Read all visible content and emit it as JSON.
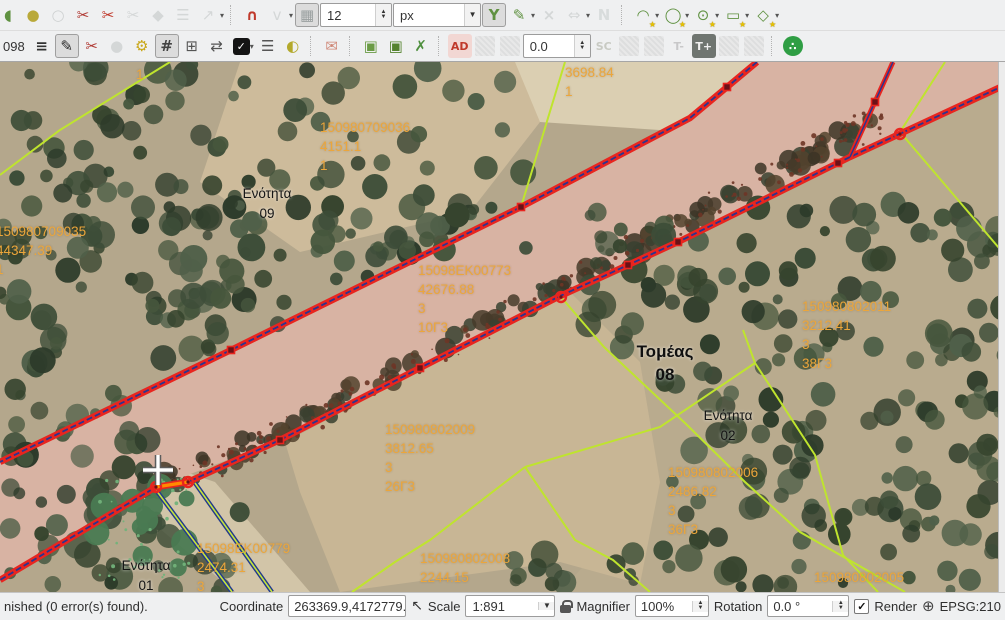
{
  "toolbar_row1": {
    "items": [
      {
        "type": "btn",
        "name": "offset-point-tool-icon",
        "glyph": "◖",
        "color": "#5f9140",
        "clip": true
      },
      {
        "type": "btn",
        "name": "move-feature-icon",
        "glyph": "●",
        "color": "#b9a93a"
      },
      {
        "type": "btn",
        "name": "simplify-feature-icon",
        "glyph": "○",
        "color": "#9aa0a0",
        "disabled": true
      },
      {
        "type": "btn",
        "name": "node-scissors-icon",
        "glyph": "✂",
        "color": "#b03a34"
      },
      {
        "type": "btn",
        "name": "split-features-icon",
        "glyph": "✂",
        "color": "#c0392b"
      },
      {
        "type": "btn",
        "name": "split-parts-icon",
        "glyph": "✂",
        "color": "#a9afaf",
        "disabled": true
      },
      {
        "type": "btn",
        "name": "merge-features-icon",
        "glyph": "◆",
        "color": "#a9afaf",
        "disabled": true
      },
      {
        "type": "btn",
        "name": "merge-attributes-icon",
        "glyph": "☰",
        "color": "#a9afaf",
        "disabled": true
      },
      {
        "type": "btn",
        "name": "rotate-feature-icon",
        "glyph": "↗",
        "color": "#a9afaf",
        "disabled": true,
        "dropdown": true
      },
      {
        "type": "sep"
      },
      {
        "type": "btn",
        "name": "snapping-magnet-icon",
        "glyph": "∩",
        "color": "#c0392b",
        "bold": true
      },
      {
        "type": "btn",
        "name": "snapping-mode-icon",
        "glyph": "v",
        "color": "#a9afaf",
        "disabled": true,
        "dropdown": true
      },
      {
        "type": "btn",
        "name": "intersection-snap-toggle",
        "glyph": "▦",
        "color": "#9aa0a0",
        "pressed": true
      },
      {
        "type": "spin",
        "name": "snap-tolerance-spinbox",
        "value": "12",
        "width": 72
      },
      {
        "type": "combo",
        "name": "snap-units-combo",
        "value": "px",
        "width": 88
      },
      {
        "type": "btn",
        "name": "tracing-toggle",
        "glyph": "Y",
        "color": "#5f9140",
        "pressed": true,
        "bold": true
      },
      {
        "type": "btn",
        "name": "trace-settings-icon",
        "glyph": "✎",
        "color": "#5f9140",
        "dropdown": true
      },
      {
        "type": "btn",
        "name": "delete-vertex-icon",
        "glyph": "×",
        "color": "#a9afaf",
        "disabled": true,
        "bold": true
      },
      {
        "type": "btn",
        "name": "move-vertex-icon",
        "glyph": "⇔",
        "color": "#a9afaf",
        "disabled": true,
        "dropdown": true
      },
      {
        "type": "btn",
        "name": "offset-curve-icon",
        "glyph": "N",
        "color": "#b5bcbc",
        "disabled": true,
        "bold": true
      },
      {
        "type": "sep"
      },
      {
        "type": "btn",
        "name": "circular-string-tool",
        "glyph": "◠",
        "color": "#5f9140",
        "badge": "★",
        "dropdown": true
      },
      {
        "type": "btn",
        "name": "circle-tool",
        "glyph": "◯",
        "color": "#5f9140",
        "badge": "★",
        "dropdown": true
      },
      {
        "type": "btn",
        "name": "ellipse-tool",
        "glyph": "⊙",
        "color": "#5f9140",
        "badge": "★",
        "dropdown": true
      },
      {
        "type": "btn",
        "name": "rectangle-tool",
        "glyph": "▭",
        "color": "#5f9140",
        "badge": "★",
        "dropdown": true
      },
      {
        "type": "btn",
        "name": "regular-polygon-tool",
        "glyph": "◇",
        "color": "#5f9140",
        "badge": "★",
        "dropdown": true
      }
    ]
  },
  "toolbar_row2": {
    "prefix_text": "098",
    "items": [
      {
        "type": "btn",
        "name": "layer-order-icon",
        "glyph": "≡",
        "color": "#333",
        "bold": true
      },
      {
        "type": "btn",
        "name": "toggle-editing-button",
        "glyph": "✎",
        "color": "#2b2b2b",
        "pressed": true
      },
      {
        "type": "btn",
        "name": "cut-node-icon",
        "glyph": "✂",
        "color": "#b03a34"
      },
      {
        "type": "btn",
        "name": "paste-node-icon",
        "glyph": "●",
        "color": "#a9afaf",
        "disabled": true
      },
      {
        "type": "btn",
        "name": "node-gear-icon",
        "glyph": "⚙",
        "color": "#c9a718"
      },
      {
        "type": "btn",
        "name": "vertex-tool-button",
        "glyph": "#",
        "color": "#444",
        "pressed": true,
        "bold": true
      },
      {
        "type": "btn",
        "name": "add-grid-record-icon",
        "glyph": "⊞",
        "color": "#555"
      },
      {
        "type": "btn",
        "name": "reload-layer-icon",
        "glyph": "⇄",
        "color": "#555"
      },
      {
        "type": "check-dd",
        "name": "select-options-toggle"
      },
      {
        "type": "btn",
        "name": "checklist-icon",
        "glyph": "☰",
        "color": "#555"
      },
      {
        "type": "btn",
        "name": "highlighter-icon",
        "glyph": "◐",
        "color": "#b3a92c"
      },
      {
        "type": "sep"
      },
      {
        "type": "btn",
        "name": "mail-icon",
        "glyph": "✉",
        "color": "#cf8878"
      },
      {
        "type": "sep"
      },
      {
        "type": "btn",
        "name": "box-3d-icon",
        "glyph": "▣",
        "color": "#6a9b44"
      },
      {
        "type": "btn",
        "name": "box-3d-filled-icon",
        "glyph": "▣",
        "color": "#55832f"
      },
      {
        "type": "btn",
        "name": "repair-tools-icon",
        "glyph": "✗",
        "color": "#4e8f3e",
        "bold": true
      },
      {
        "type": "sep"
      },
      {
        "type": "btn",
        "name": "ad-plugin-button",
        "text": "AD",
        "color": "#c0392b",
        "bg": "#f2d7d3"
      },
      {
        "type": "swatch",
        "name": "disabled-plugin-1"
      },
      {
        "type": "swatch",
        "name": "disabled-plugin-2"
      },
      {
        "type": "spin",
        "name": "angle-spinbox",
        "value": "0.0",
        "width": 68
      },
      {
        "type": "btn",
        "name": "sc-plugin-button",
        "text": "SC",
        "color": "#8a8f7a",
        "disabled": true
      },
      {
        "type": "swatch",
        "name": "disabled-plugin-3"
      },
      {
        "type": "swatch",
        "name": "disabled-plugin-4"
      },
      {
        "type": "btn",
        "name": "text-smaller-button",
        "text": "T-",
        "color": "#8a8a8a",
        "disabled": true
      },
      {
        "type": "btn",
        "name": "text-larger-button",
        "text": "T+",
        "color": "#f0f0f0",
        "bg": "#6f7570"
      },
      {
        "type": "swatch",
        "name": "disabled-plugin-5"
      },
      {
        "type": "swatch",
        "name": "disabled-plugin-6"
      },
      {
        "type": "sep"
      },
      {
        "type": "btn",
        "name": "share-button",
        "text": "∴",
        "color": "#ffffff",
        "circle": "#2f9e44"
      }
    ]
  },
  "map": {
    "labels": [
      {
        "name": "label-top-1",
        "left": 136,
        "top": 3,
        "style": "orange",
        "lines": [
          "1"
        ]
      },
      {
        "name": "label-3698",
        "left": 565,
        "top": 1,
        "style": "orange",
        "lines": [
          "3698.84",
          "1"
        ]
      },
      {
        "name": "label-150980709036",
        "left": 320,
        "top": 56,
        "style": "orange",
        "lines": [
          "150980709036",
          "4151.1",
          "1"
        ]
      },
      {
        "name": "label-unit-09",
        "left": 237,
        "top": 122,
        "style": "dark",
        "width": 60,
        "lines": [
          "Ενότητα",
          "09"
        ]
      },
      {
        "name": "label-150980709035",
        "left": -4,
        "top": 160,
        "style": "orange",
        "lines": [
          "150980709035",
          "44347.39",
          "1"
        ]
      },
      {
        "name": "label-15098EK00773",
        "left": 418,
        "top": 199,
        "style": "orange",
        "lines": [
          "15098EK00773",
          "42676.88",
          "3",
          "10Γ3"
        ]
      },
      {
        "name": "label-150980802011",
        "left": 802,
        "top": 235,
        "style": "orange",
        "lines": [
          "150980802011",
          "3212.41",
          "3",
          "38Γ3"
        ]
      },
      {
        "name": "label-sector-08",
        "left": 630,
        "top": 278,
        "style": "dark-bold",
        "width": 70,
        "lines": [
          "Τομέας",
          "08"
        ]
      },
      {
        "name": "label-unit-02",
        "left": 698,
        "top": 344,
        "style": "dark",
        "width": 60,
        "lines": [
          "Ενότητα",
          "02"
        ]
      },
      {
        "name": "label-150980802009",
        "left": 385,
        "top": 358,
        "style": "orange",
        "lines": [
          "150980802009",
          "3812.65",
          "3",
          "26Γ3"
        ]
      },
      {
        "name": "label-150980802006",
        "left": 668,
        "top": 401,
        "style": "orange",
        "lines": [
          "150980802006",
          "2486.82",
          "3",
          "36Γ3"
        ]
      },
      {
        "name": "label-15098EK00779",
        "left": 197,
        "top": 477,
        "style": "orange",
        "lines": [
          "15098EK00779",
          "2474.31",
          "3"
        ]
      },
      {
        "name": "label-unit-01",
        "left": 116,
        "top": 494,
        "style": "dark",
        "width": 60,
        "lines": [
          "Ενότητα",
          "01"
        ]
      },
      {
        "name": "label-150980802008",
        "left": 420,
        "top": 487,
        "style": "orange",
        "lines": [
          "150980802008",
          "2244.15"
        ]
      },
      {
        "name": "label-150980802005",
        "left": 814,
        "top": 506,
        "style": "orange",
        "lines": [
          "150980802005"
        ]
      }
    ],
    "colors": {
      "parcel_line": "#bfe42e",
      "road_edge_red": "#e8251f",
      "road_edge_navy": "#2a3590",
      "selected_segment_orange": "#ff8a00",
      "label_orange": "#eca63b"
    }
  },
  "status_bar": {
    "message": "nished (0 error(s) found).",
    "coordinate_label": "Coordinate",
    "coordinate_value": "263369.9,4172779.6",
    "scale_label": "Scale",
    "scale_value": "1:891",
    "magnifier_label": "Magnifier",
    "magnifier_value": "100%",
    "rotation_label": "Rotation",
    "rotation_value": "0.0 °",
    "render_label": "Render",
    "crs_label": "EPSG:210"
  }
}
